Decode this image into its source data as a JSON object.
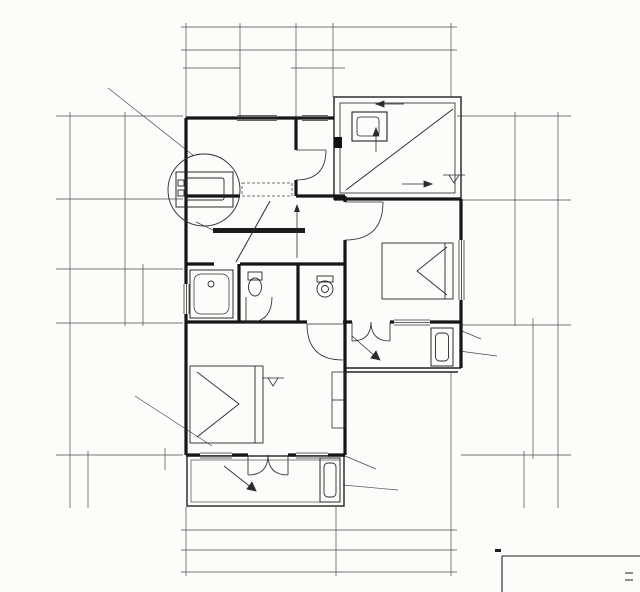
{
  "meta": {
    "title": "二层平面",
    "scale": "1:1",
    "line_color": "#1c1c1c",
    "bg_color": "#fcfcfb"
  },
  "rooms": [
    {
      "name": "储藏(书房)",
      "area": "7.5M²"
    },
    {
      "name": "卧室",
      "area": "13.8M²"
    },
    {
      "name": "主卧室",
      "area": "18.1M²"
    },
    {
      "name": "阳台"
    },
    {
      "name": "阳台"
    },
    {
      "area": "4.5M²"
    }
  ],
  "grid_bubbles": {
    "top": [
      {
        "l": "1",
        "x": 188,
        "y": 11
      },
      {
        "l": "2",
        "x": 240,
        "y": 11
      },
      {
        "l": "3",
        "x": 296,
        "y": 11
      },
      {
        "l": "4",
        "x": 333,
        "y": 11
      },
      {
        "l": "6",
        "x": 450,
        "y": 11
      }
    ],
    "bottom": [
      {
        "l": "1",
        "x": 190,
        "y": 586
      },
      {
        "l": "5",
        "x": 338,
        "y": 586
      },
      {
        "l": "6",
        "x": 452,
        "y": 586
      }
    ],
    "left": [
      {
        "l": "E",
        "x": 44,
        "y": 116
      },
      {
        "l": "D",
        "x": 44,
        "y": 199
      },
      {
        "l": "C",
        "x": 44,
        "y": 269
      },
      {
        "l": "B",
        "x": 44,
        "y": 323
      },
      {
        "l": "A",
        "x": 44,
        "y": 455
      }
    ],
    "right": [
      {
        "l": "E",
        "x": 583,
        "y": 116
      },
      {
        "l": "D",
        "x": 583,
        "y": 200
      },
      {
        "l": "B",
        "x": 583,
        "y": 325
      },
      {
        "l": "A",
        "x": 583,
        "y": 455
      }
    ]
  },
  "callouts": [
    {
      "num": "1",
      "ref": "—",
      "x": 97,
      "y": 78
    },
    {
      "num": "1",
      "ref": "J-16",
      "x": 122,
      "y": 391
    }
  ],
  "labels": [
    {
      "t": "8440",
      "x": 322,
      "y": 23
    },
    {
      "t": "120",
      "x": 188,
      "y": 40,
      "s": 6.5
    },
    {
      "t": "1200",
      "x": 209,
      "y": 45
    },
    {
      "t": "2000",
      "x": 251,
      "y": 44
    },
    {
      "t": "1300",
      "x": 295,
      "y": 45
    },
    {
      "t": "3700",
      "x": 394,
      "y": 43
    },
    {
      "t": "120",
      "x": 451,
      "y": 39,
      "s": 6.5
    },
    {
      "t": "280",
      "x": 191,
      "y": 62,
      "s": 6.5
    },
    {
      "t": "700",
      "x": 209,
      "y": 63,
      "s": 6.5
    },
    {
      "t": "220",
      "x": 228,
      "y": 63,
      "s": 6.5
    },
    {
      "t": "180",
      "x": 294,
      "y": 64,
      "s": 6.5
    },
    {
      "t": "800",
      "x": 310,
      "y": 64,
      "s": 6.5
    },
    {
      "t": "320",
      "x": 331,
      "y": 64,
      "s": 6.5
    },
    {
      "t": "烟囱",
      "x": 392,
      "y": 70,
      "s": 7,
      "n": "flue-label"
    },
    {
      "t": "空调室外机栏板",
      "x": 147,
      "y": 66,
      "s": 7,
      "n": "ac-rail-note"
    },
    {
      "t": "C0713",
      "x": 214,
      "y": 209,
      "r": -10,
      "s": 7,
      "n": "window-code"
    },
    {
      "t": "空调管洞Ø80洞中离地2500",
      "x": 152,
      "y": 219,
      "s": 6.8,
      "u": 1,
      "n": "ac-hole-note"
    },
    {
      "t": "460",
      "x": 256,
      "y": 106,
      "r": -90,
      "s": 6.5
    },
    {
      "t": "C0816",
      "x": 313,
      "y": 126,
      "n": "window-code"
    },
    {
      "t": "储藏(书房)",
      "x": 274,
      "y": 139,
      "s": 8,
      "n": "room-name-storage"
    },
    {
      "t": "7.5M²",
      "x": 275,
      "y": 153,
      "s": 7.5,
      "n": "room-area"
    },
    {
      "t": "2010",
      "x": 268,
      "y": 165
    },
    {
      "t": "950",
      "x": 314,
      "y": 165
    },
    {
      "t": "M9521",
      "x": 316,
      "y": 190,
      "r": -90,
      "s": 6.5,
      "n": "door-code"
    },
    {
      "t": "M9521B",
      "x": 327,
      "y": 221,
      "r": -90,
      "s": 6.5,
      "n": "door-code"
    },
    {
      "t": "950",
      "x": 362,
      "y": 225,
      "r": -90,
      "s": 6.5
    },
    {
      "t": "100",
      "x": 350,
      "y": 200,
      "r": -90,
      "s": 6.5
    },
    {
      "t": "下",
      "x": 288,
      "y": 212,
      "s": 8,
      "n": "stair-down-label"
    },
    {
      "t": "上",
      "x": 292,
      "y": 243,
      "s": 8,
      "n": "stair-up-label"
    },
    {
      "t": "1080",
      "x": 215,
      "y": 251
    },
    {
      "t": "i=1.0%",
      "x": 398,
      "y": 95,
      "s": 7.5,
      "n": "slope-label"
    },
    {
      "t": "i=70.0%",
      "x": 363,
      "y": 157,
      "r": -90,
      "s": 9,
      "n": "slope-label"
    },
    {
      "t": "i=70.0%",
      "x": 417,
      "y": 173,
      "s": 9,
      "n": "slope-label"
    },
    {
      "t": "3.200",
      "x": 459,
      "y": 169,
      "s": 7,
      "n": "level-label"
    },
    {
      "t": "1.910",
      "x": 351,
      "y": 178,
      "s": 6.5
    },
    {
      "t": "i=1.0%",
      "x": 464,
      "y": 142,
      "r": -90,
      "s": 6,
      "n": "slope-label"
    },
    {
      "t": "100",
      "x": 348,
      "y": 205,
      "r": -90,
      "s": 6
    },
    {
      "t": "2700",
      "x": 519,
      "y": 164,
      "r": -90
    },
    {
      "t": "4100",
      "x": 529,
      "y": 261,
      "r": -90
    },
    {
      "t": "12740",
      "x": 555,
      "y": 302,
      "r": -90
    },
    {
      "t": "4200",
      "x": 530,
      "y": 378,
      "r": -90
    },
    {
      "t": "1520",
      "x": 522,
      "y": 486,
      "r": -90
    },
    {
      "t": "100",
      "x": 551,
      "y": 502,
      "r": -90,
      "s": 6.5
    },
    {
      "t": "空调管洞Ø80洞中离地2500",
      "x": 524,
      "y": 338,
      "s": 6.8,
      "u": 1,
      "n": "ac-hole-note"
    },
    {
      "t": "室外机",
      "x": 506,
      "y": 355,
      "s": 7,
      "n": "ac-outdoor-unit-note"
    },
    {
      "t": "120",
      "x": 87,
      "y": 112,
      "r": -90,
      "s": 6.5
    },
    {
      "t": "2700",
      "x": 120,
      "y": 166,
      "r": -90
    },
    {
      "t": "2300",
      "x": 120,
      "y": 233,
      "r": -90
    },
    {
      "t": "1800",
      "x": 95,
      "y": 303,
      "r": -90
    },
    {
      "t": "12740",
      "x": 64,
      "y": 300,
      "r": -90
    },
    {
      "t": "500",
      "x": 138,
      "y": 277,
      "r": -90,
      "s": 6.5
    },
    {
      "t": "800",
      "x": 138,
      "y": 299,
      "r": -90,
      "s": 6.5
    },
    {
      "t": "500",
      "x": 138,
      "y": 320,
      "r": -90,
      "s": 6.5
    },
    {
      "t": "4200",
      "x": 92,
      "y": 382,
      "r": -90
    },
    {
      "t": "1520",
      "x": 84,
      "y": 483,
      "r": -90
    },
    {
      "t": "100",
      "x": 81,
      "y": 502,
      "r": -90,
      "s": 6.5
    },
    {
      "t": "300",
      "x": 160,
      "y": 463,
      "r": -90,
      "s": 6.5
    },
    {
      "t": "100",
      "x": 191,
      "y": 477,
      "r": -90,
      "s": 6.5
    },
    {
      "t": "C0816",
      "x": 182,
      "y": 297,
      "r": -90,
      "s": 6.5,
      "n": "window-code"
    },
    {
      "t": "4.5M²",
      "x": 209,
      "y": 296,
      "s": 7.5,
      "n": "room-area"
    },
    {
      "t": "M752B",
      "x": 251,
      "y": 303,
      "r": -90,
      "s": 6.5,
      "n": "door-code"
    },
    {
      "t": "750",
      "x": 264,
      "y": 308,
      "r": -90,
      "s": 6.5
    },
    {
      "t": "710",
      "x": 277,
      "y": 284,
      "r": -90,
      "s": 6.5
    },
    {
      "t": "100",
      "x": 290,
      "y": 312,
      "r": -90,
      "s": 6.5
    },
    {
      "t": "900",
      "x": 303,
      "y": 276,
      "r": -90,
      "s": 6.5
    },
    {
      "t": "900",
      "x": 303,
      "y": 304,
      "r": -90,
      "s": 6.5
    },
    {
      "t": "120",
      "x": 333,
      "y": 286,
      "s": 6.5
    },
    {
      "t": "500",
      "x": 322,
      "y": 303,
      "s": 6.5
    },
    {
      "t": "680",
      "x": 347,
      "y": 302,
      "box": 1,
      "s": 6.5
    },
    {
      "t": "2810",
      "x": 357,
      "y": 271,
      "r": -90
    },
    {
      "t": "卧室",
      "x": 371,
      "y": 264,
      "s": 8,
      "n": "room-name-bedroom"
    },
    {
      "t": "13.8M²",
      "x": 376,
      "y": 287,
      "s": 7.5,
      "n": "room-area"
    },
    {
      "t": "460",
      "x": 430,
      "y": 237
    },
    {
      "t": "M9521B",
      "x": 318,
      "y": 337,
      "s": 6.5,
      "n": "door-code"
    },
    {
      "t": "JM1224",
      "x": 385,
      "y": 312,
      "n": "door-code"
    },
    {
      "t": "C1216",
      "x": 418,
      "y": 311,
      "n": "window-code"
    },
    {
      "t": "1400",
      "x": 390,
      "y": 348,
      "r": -90
    },
    {
      "t": "阳台",
      "x": 421,
      "y": 346,
      "s": 7.5,
      "n": "room-name-balcony"
    },
    {
      "t": "i=1.0%",
      "x": 369,
      "y": 352,
      "r": 38,
      "s": 7,
      "n": "slope-label"
    },
    {
      "t": "100",
      "x": 407,
      "y": 372,
      "r": -90,
      "s": 6.5
    },
    {
      "t": "250",
      "x": 349,
      "y": 377,
      "s": 6.5
    },
    {
      "t": "350",
      "x": 337,
      "y": 388,
      "s": 6.5
    },
    {
      "t": "3260",
      "x": 252,
      "y": 362
    },
    {
      "t": "950",
      "x": 314,
      "y": 362
    },
    {
      "t": "3.200",
      "x": 273,
      "y": 373,
      "s": 7,
      "n": "level-label"
    },
    {
      "t": "主卧室",
      "x": 268,
      "y": 407,
      "s": 8,
      "n": "room-name-master-bedroom"
    },
    {
      "t": "18.1M²",
      "x": 274,
      "y": 419,
      "s": 7.5,
      "n": "room-area"
    },
    {
      "t": "C1016",
      "x": 226,
      "y": 445,
      "n": "window-code"
    },
    {
      "t": "JM1224",
      "x": 268,
      "y": 444,
      "n": "door-code"
    },
    {
      "t": "C1016",
      "x": 310,
      "y": 442,
      "n": "window-code"
    },
    {
      "t": "窗台",
      "x": 152,
      "y": 382,
      "s": 7,
      "n": "sill-note"
    },
    {
      "t": "阳台",
      "x": 268,
      "y": 481,
      "s": 7.5,
      "n": "room-name-balcony"
    },
    {
      "t": "i=1.0%",
      "x": 238,
      "y": 478,
      "r": 28,
      "s": 7,
      "n": "slope-label"
    },
    {
      "t": "1400",
      "x": 289,
      "y": 482,
      "r": -90
    },
    {
      "t": "空调管洞Ø80洞中离地2500",
      "x": 420,
      "y": 467,
      "s": 6.8,
      "u": 1,
      "n": "ac-hole-note"
    },
    {
      "t": "室外机",
      "x": 400,
      "y": 490,
      "s": 7,
      "n": "ac-outdoor-unit-note"
    },
    {
      "t": "510",
      "x": 184,
      "y": 522,
      "s": 6.5
    },
    {
      "t": "1050",
      "x": 203,
      "y": 523,
      "s": 6.5
    },
    {
      "t": "240",
      "x": 239,
      "y": 512,
      "s": 6.5
    },
    {
      "t": "1200",
      "x": 263,
      "y": 523,
      "s": 6.5
    },
    {
      "t": "240",
      "x": 294,
      "y": 511,
      "s": 6.5
    },
    {
      "t": "1050",
      "x": 321,
      "y": 523,
      "s": 6.5
    },
    {
      "t": "510",
      "x": 340,
      "y": 523,
      "s": 6.5
    },
    {
      "t": "380",
      "x": 352,
      "y": 509,
      "s": 6.5
    },
    {
      "t": "1200",
      "x": 371,
      "y": 523,
      "s": 6.5
    },
    {
      "t": "240",
      "x": 401,
      "y": 511,
      "s": 6.5
    },
    {
      "t": "1200",
      "x": 421,
      "y": 523,
      "s": 6.5
    },
    {
      "t": "380",
      "x": 449,
      "y": 510,
      "s": 6.5
    },
    {
      "t": "4800",
      "x": 258,
      "y": 547
    },
    {
      "t": "3400",
      "x": 406,
      "y": 547
    },
    {
      "t": "120",
      "x": 190,
      "y": 572,
      "s": 6.5
    },
    {
      "t": "8440",
      "x": 322,
      "y": 570
    },
    {
      "t": "120",
      "x": 452,
      "y": 572,
      "s": 6.5
    }
  ]
}
